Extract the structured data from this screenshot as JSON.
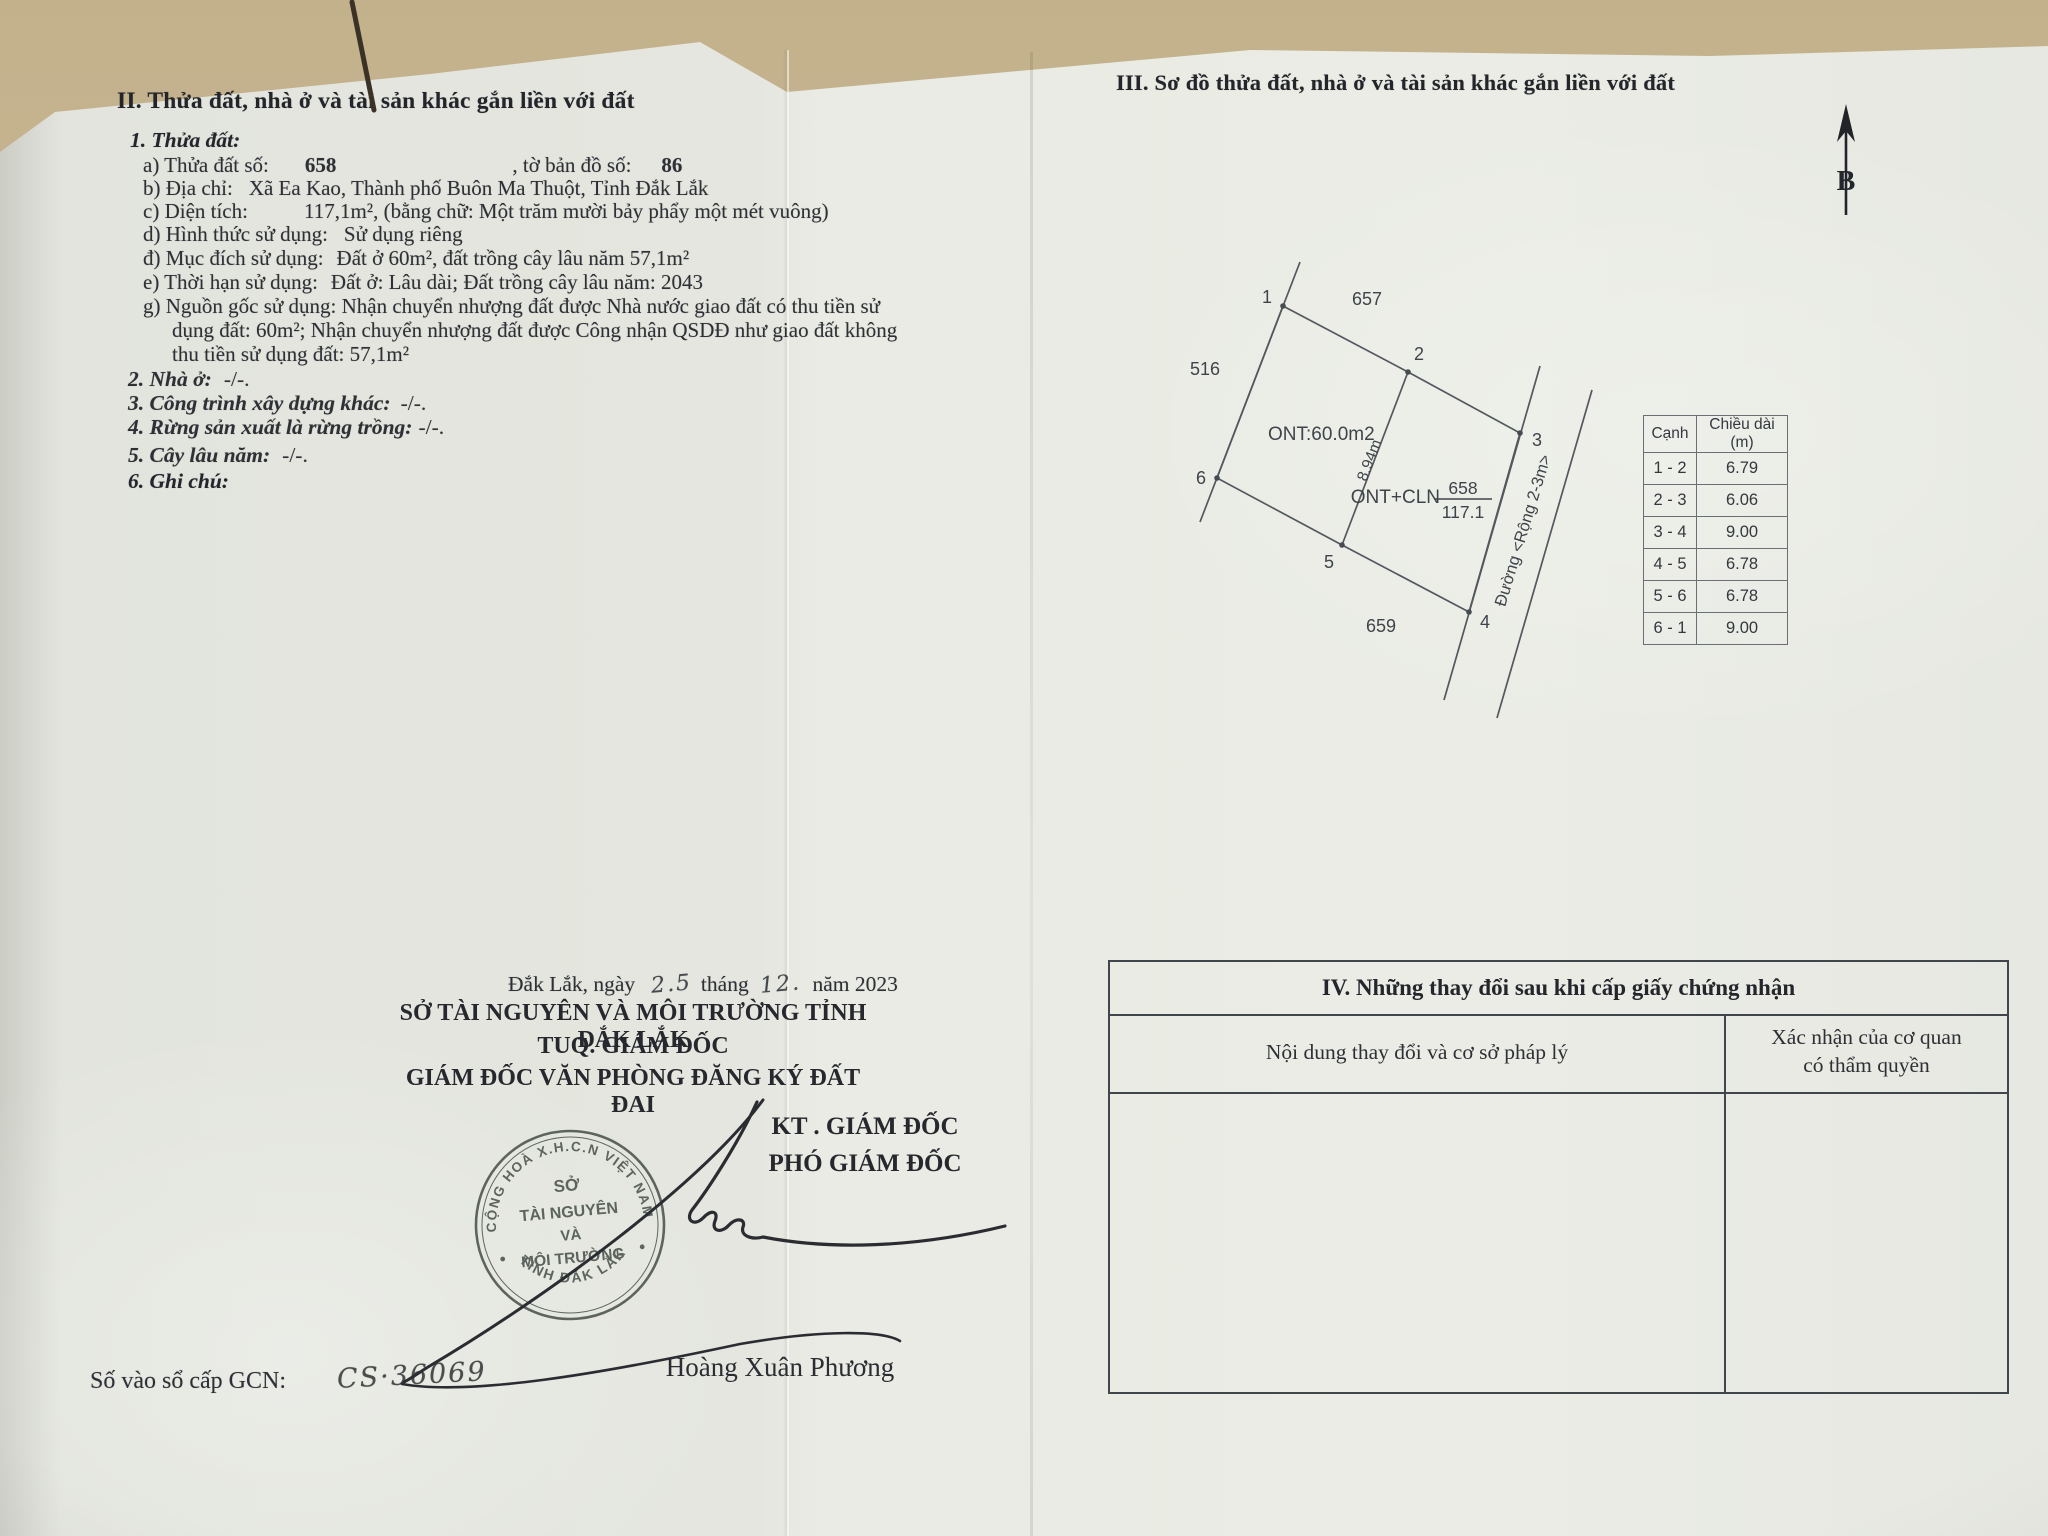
{
  "section2": {
    "title": "II. Thửa đất, nhà ở và tài sản khác gắn liền với đất",
    "item1_label": "1. Thửa đất:",
    "a_label": "a) Thửa đất số:",
    "a_value": "658",
    "a_mid": ", tờ bản đồ số:",
    "a_value2": "86",
    "b_label": "b) Địa chỉ:",
    "b_value": "Xã Ea Kao, Thành phố Buôn Ma Thuột, Tỉnh Đắk Lắk",
    "c_label": "c) Diện tích:",
    "c_value": "117,1m²",
    "c_suffix": ", (bằng chữ: Một trăm mười bảy phẩy một mét vuông)",
    "d_label": "d) Hình thức sử dụng:",
    "d_value": "Sử dụng riêng",
    "dd_label": "đ) Mục đích sử dụng:",
    "dd_value": "Đất ở 60m², đất trồng cây lâu năm 57,1m²",
    "e_label": "e) Thời hạn sử dụng:",
    "e_value": "Đất ở: Lâu dài; Đất trồng cây lâu năm: 2043",
    "g_line1": "g) Nguồn gốc sử dụng:  Nhận chuyển nhượng đất được Nhà nước giao đất có thu tiền sử",
    "g_line2": "dụng đất: 60m²; Nhận chuyển nhượng đất được Công nhận QSDĐ như giao đất không",
    "g_line3": "thu tiền sử dụng đất: 57,1m²",
    "item2_label": "2. Nhà ở:",
    "item2_value": "-/-.",
    "item3_label": "3. Công trình xây dựng khác:",
    "item3_value": "-/-.",
    "item4_label": "4. Rừng sản xuất là rừng trồng:",
    "item4_value": "-/-.",
    "item5_label": "5. Cây lâu năm:",
    "item5_value": "-/-.",
    "item6_label": "6. Ghi chú:"
  },
  "section3": {
    "title": "III. Sơ đồ thửa đất, nhà ở và tài sản khác gắn liền với đất",
    "north_label": "B",
    "diagram": {
      "vertex1": "1",
      "vertex2": "2",
      "vertex3": "3",
      "vertex4": "4",
      "vertex5": "5",
      "vertex6": "6",
      "neighbor_top": "657",
      "neighbor_left": "516",
      "neighbor_bottom": "659",
      "area_left_label": "ONT:60.0m2",
      "divider_length": "8.94m",
      "parcel_use": "ONT+CLN",
      "parcel_number": "658",
      "parcel_area": "117.1",
      "road_label": "Đường <Rộng 2-3m>"
    },
    "edge_table": {
      "header_edge": "Cạnh",
      "header_length": "Chiều dài (m)",
      "rows": [
        [
          "1 - 2",
          "6.79"
        ],
        [
          "2 - 3",
          "6.06"
        ],
        [
          "3 - 4",
          "9.00"
        ],
        [
          "4 - 5",
          "6.78"
        ],
        [
          "5 - 6",
          "6.78"
        ],
        [
          "6 - 1",
          "9.00"
        ]
      ]
    }
  },
  "section4": {
    "title": "IV. Những thay đổi sau khi cấp giấy chứng nhận",
    "col1_header": "Nội dung thay đổi và cơ sở pháp lý",
    "col2_header_line1": "Xác nhận của cơ quan",
    "col2_header_line2": "có thẩm quyền"
  },
  "signature": {
    "date_prefix": "Đắk Lắk, ngày",
    "date_day": "2.5",
    "date_mid": "tháng",
    "date_month": "12.",
    "date_suffix": "năm 2023",
    "org_line1": "SỞ TÀI NGUYÊN VÀ MÔI TRƯỜNG TỈNH ĐẮK LẮK",
    "org_line2": "TUQ. GIÁM ĐỐC",
    "org_line3": "GIÁM ĐỐC VĂN PHÒNG ĐĂNG KÝ ĐẤT ĐAI",
    "kt_line": "KT . GIÁM ĐỐC",
    "deputy_line": "PHÓ GIÁM ĐỐC",
    "signer_name": "Hoàng Xuân Phương",
    "seal": {
      "ring_top": "CỘNG HOÀ X.H.C.N VIỆT NAM",
      "ring_bottom": "TỈNH ĐẮK LẮK",
      "center_line1": "SỞ",
      "center_line2": "TÀI NGUYÊN",
      "center_line3": "VÀ",
      "center_line4": "MÔI TRƯỜNG"
    }
  },
  "footer": {
    "gcn_label": "Số vào sổ cấp GCN:",
    "gcn_value": "CS·36069"
  },
  "colors": {
    "paper": "#e8eae3",
    "background": "#cdbc99",
    "ink": "#2e3036",
    "seal_ink": "#4b524d"
  }
}
